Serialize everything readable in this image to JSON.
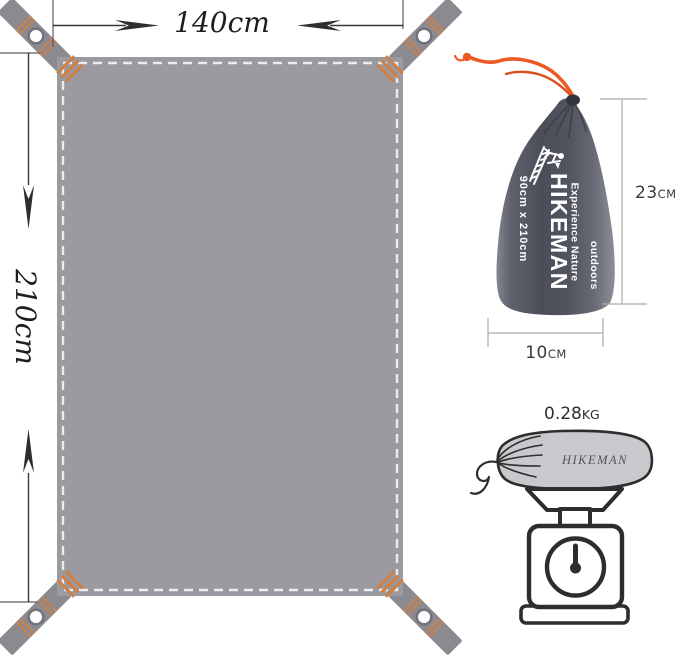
{
  "product": {
    "brand": "HIKEMAN"
  },
  "tarp_diagram": {
    "width_label": "140cm",
    "height_label": "210cm"
  },
  "bag_diagram": {
    "brand": "HIKEMAN",
    "tagline1": "Experience Nature",
    "tagline2": "outdoors",
    "size_label": "90cm x 210cm",
    "height_value": "23",
    "height_unit": "CM",
    "width_value": "10",
    "width_unit": "CM"
  },
  "weight_diagram": {
    "value": "0.28",
    "unit": "KG",
    "sack_label": "HIKEMAN"
  },
  "colors": {
    "tarp_gray": "#9a9aa0",
    "strap_gray": "#8a8a90",
    "stitch_white": "#ececef",
    "accent_orange": "#cd8148",
    "cord_orange": "#ed5a24",
    "bag_dark": "#4c4e59",
    "ink": "#2d2d2d"
  }
}
